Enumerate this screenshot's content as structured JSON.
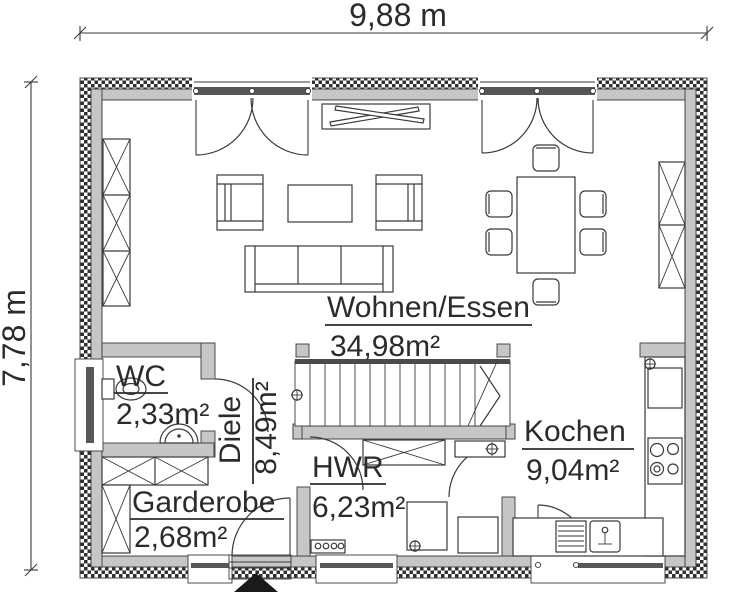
{
  "plan": {
    "dimensions": {
      "total_width": "9,88 m",
      "total_height": "7,78 m"
    },
    "rooms": {
      "wohnen_essen": {
        "name": "Wohnen/Essen",
        "area": "34,98m²"
      },
      "kochen": {
        "name": "Kochen",
        "area": "9,04m²"
      },
      "wc": {
        "name": "WC",
        "area": "2,33m²"
      },
      "diele": {
        "name": "Diele",
        "area": "8,49m²"
      },
      "hwr": {
        "name": "HWR",
        "area": "6,23m²"
      },
      "garderobe": {
        "name": "Garderobe",
        "area": "2,68m²"
      }
    },
    "colors": {
      "wall_fill": "#c6c6c6",
      "outline": "#3a3a3a",
      "background": "#ffffff"
    }
  }
}
